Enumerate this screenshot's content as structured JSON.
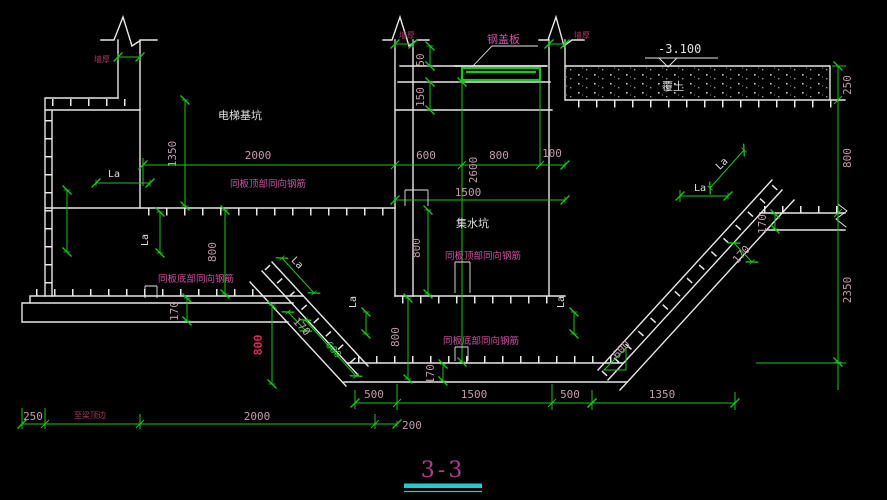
{
  "drawing": {
    "title": "3-3",
    "labels": {
      "elevator_pit": "电梯基坑",
      "sump_pit": "集水坑",
      "steel_cover_plate": "钢盖板",
      "soil_cover": "覆土",
      "elevation": "-3.100",
      "wall_thickness_left": "墙厚",
      "wall_thickness_mid": "墙厚",
      "wall_thickness_right": "墙厚",
      "top_rebar_left": "同板顶部同向钢筋",
      "top_rebar_sump": "同板顶部同向钢筋",
      "bottom_rebar_left": "同板底部同向钢筋",
      "bottom_rebar_sump": "同板底部同向钢筋",
      "to_beam_edge": "至梁顶边",
      "la": "La"
    },
    "dims": {
      "plate_top": "50",
      "plate_ledge": "150",
      "pit_depth": "1350",
      "pit_width": "2000",
      "plate_left": "600",
      "plate_width": "800",
      "plate_right": "100",
      "shaft_depth": "2600",
      "sump_width": "1500",
      "sump_depth": "800",
      "slab_thickness": "800",
      "slab_drop_left": "800",
      "sump_wall_drop": "800",
      "soil_cover": "250",
      "right_slab_depth": "800",
      "right_pit_depth": "2350",
      "cushion_left": "170",
      "cushion_diag_left": "170",
      "cushion_bottom": "170",
      "cushion_diag_right": "170",
      "cushion_right": "170",
      "slope_left": "600",
      "slope_right": "600",
      "bottom_left_seg": "500",
      "bottom_mid_seg": "1500",
      "bottom_right_seg": "500",
      "bottom_far_right": "1350",
      "edge_offset": "250",
      "bottom_width": "2000",
      "edge_right": "200"
    },
    "colors": {
      "background": "#000000",
      "line_white": "#e8e8e8",
      "dim_green": "#1dc41d",
      "dim_text": "#c49aae",
      "label_magenta": "#cf52a6",
      "wall_label": "#a8395f",
      "red_highlight": "#d42a55",
      "white_label": "#e0e0e0",
      "green_text": "#2ad42a",
      "title_magenta": "#ae3d93",
      "underline_cyan": "#22cccc"
    }
  }
}
